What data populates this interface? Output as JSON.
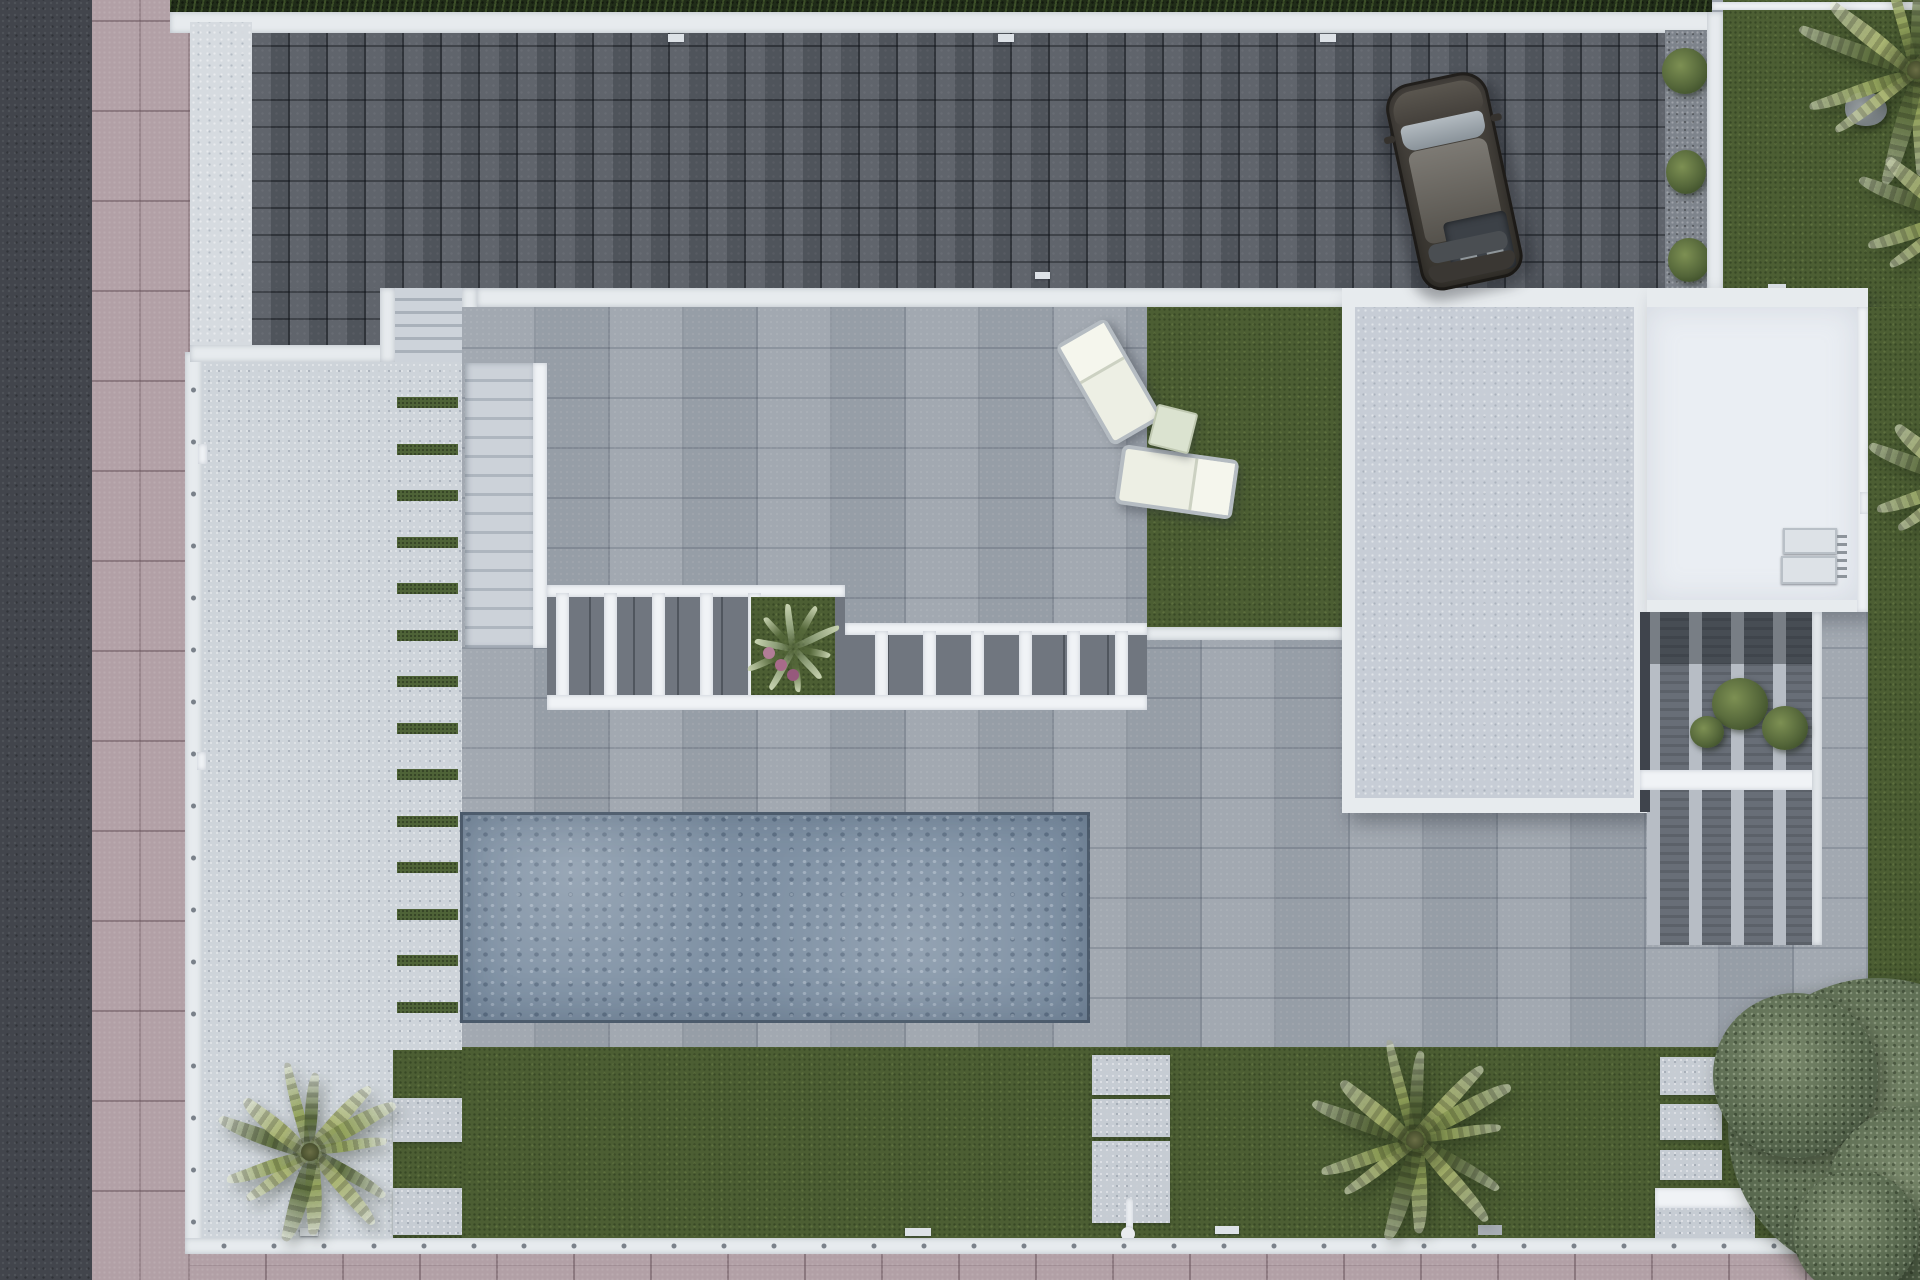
{
  "meta": {
    "description": "Top-down aerial 3D architectural render of a modern villa plot: dark paver driveway with parked car, striped garden path, pool terrace with pergola, flat roofs, lawns and palm trees",
    "render_type": "architectural-site-plan-render"
  },
  "palette": {
    "asphalt": "#42454c",
    "sidewalk": "#b2a0a6",
    "wall": "#e7ebee",
    "concrete": "#ced4da",
    "pavers_dark": "#565b63",
    "pavers_terrace": "#9da4ad",
    "grass": "#4c5e33",
    "grass_stripe": "#4e6337",
    "pool": "#7f91a4",
    "roof_main": "#c7cdd6",
    "roof_white": "#eaeef3",
    "hedge": "#202c18",
    "palm_green": "#8d9b5a",
    "car_body": "#413e3a",
    "cushion": "#edefe4"
  },
  "objects": {
    "pool": {
      "x": 460,
      "y": 812,
      "w": 630,
      "h": 211
    },
    "car": {
      "x": 1402,
      "y": 76,
      "angle": -12
    },
    "lounge_chairs": [
      {
        "x": 1080,
        "y": 324,
        "w": 58,
        "h": 116,
        "angle": -30
      },
      {
        "x": 1118,
        "y": 452,
        "w": 118,
        "h": 60,
        "angle": 8
      }
    ],
    "side_table": {
      "x": 1152,
      "y": 408,
      "size": 42,
      "angle": 14
    },
    "path_stripes": {
      "x": 397,
      "width": 61,
      "first_y": 397,
      "step": 46.5,
      "count": 14,
      "height": 11
    },
    "pergola_posts": [
      {
        "start_x": 556,
        "step": 48,
        "count": 5,
        "top": 593,
        "height": 106
      },
      {
        "start_x": 875,
        "step": 48,
        "count": 6,
        "top": 631,
        "height": 68
      }
    ],
    "palms": [
      {
        "name": "palm-bottom-left",
        "x": 310,
        "y": 1152,
        "r": 100,
        "tone": 0
      },
      {
        "name": "palm-bottom-center",
        "x": 1415,
        "y": 1140,
        "r": 112,
        "tone": 1
      },
      {
        "name": "palm-top-right-a",
        "x": 1916,
        "y": 70,
        "r": 128,
        "tone": 0
      },
      {
        "name": "palm-top-right-b",
        "x": 1958,
        "y": 215,
        "r": 108,
        "tone": 1
      },
      {
        "name": "palm-right-edge",
        "x": 1964,
        "y": 480,
        "r": 104,
        "tone": 0
      }
    ],
    "olive_tree": {
      "x": 1878,
      "y": 1128,
      "r": 150
    },
    "rock": {
      "x": 1845,
      "y": 92,
      "w": 42,
      "h": 34
    }
  },
  "counts": {
    "palm_trees": 5,
    "shade_trees": 1,
    "lounge_chairs": 2,
    "vehicles": 1,
    "pools": 1
  }
}
